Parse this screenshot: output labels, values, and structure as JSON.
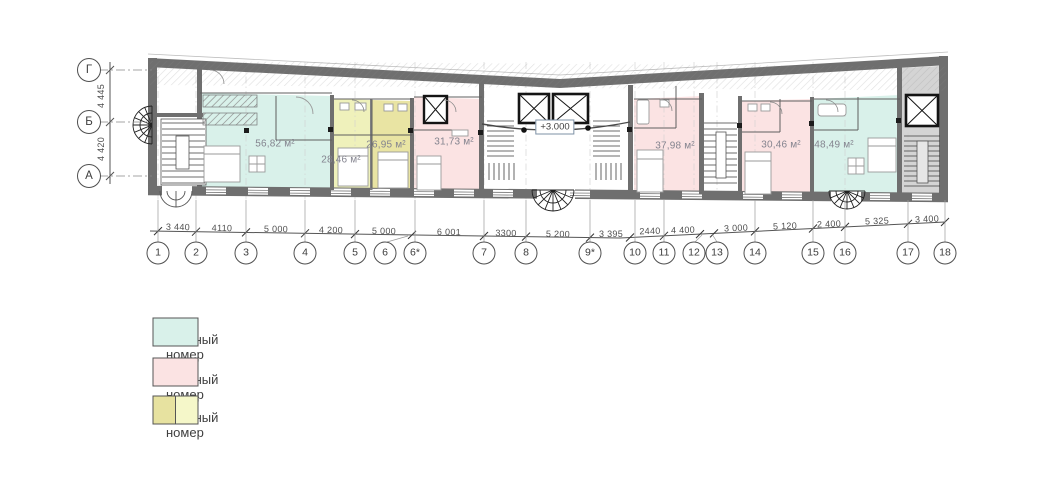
{
  "plan": {
    "row_axes": [
      "Г",
      "Б",
      "А"
    ],
    "row_dimensions": [
      "4 445",
      "4 420"
    ],
    "column_axes": [
      "1",
      "2",
      "3",
      "4",
      "5",
      "6",
      "6*",
      "7",
      "8",
      "9*",
      "10",
      "11",
      "12",
      "13",
      "14",
      "15",
      "16",
      "17",
      "18"
    ],
    "column_dimensions": [
      "3 440",
      "4110",
      "5 000",
      "4 200",
      "5 000",
      "6 001",
      "3300",
      "5 200",
      "3 395",
      "2440",
      "4 400",
      "3 000",
      "5 120",
      "2 400",
      "5 325",
      "3 400"
    ],
    "rooms": [
      {
        "area": "56,82 м²",
        "type": "2-3 местный номер",
        "color": "#d9f1ea"
      },
      {
        "area": "28,46 м²",
        "type": "1-2 местный номер",
        "color": "#eff1bb"
      },
      {
        "area": "26,95 м²",
        "type": "1-2 местный номер",
        "color": "#e9e4a3"
      },
      {
        "area": "31,73 м²",
        "type": "2 местный номер",
        "color": "#fbe3e3"
      },
      {
        "area": "37,98 м²",
        "type": "2 местный номер",
        "color": "#fbe3e3"
      },
      {
        "area": "30,46 м²",
        "type": "2 местный номер",
        "color": "#fbe3e3"
      },
      {
        "area": "48,49 м²",
        "type": "2-3 местный номер",
        "color": "#d9f1ea"
      }
    ],
    "elevation_mark": "+3.000"
  },
  "legend": {
    "items": [
      {
        "label": "- 2-3 местный номер",
        "swatch": "#d9f1ea"
      },
      {
        "label": "- 2 местный номер",
        "swatch": "#fbe3e3"
      },
      {
        "label": "- 1-2 местный номер",
        "swatch_left": "#e7e2a0",
        "swatch_right": "#f5f7c9"
      }
    ]
  },
  "colors": {
    "walls": "#6f6f6f",
    "stair_floor": "#d4d4d4",
    "dim_lines": "#555555"
  }
}
